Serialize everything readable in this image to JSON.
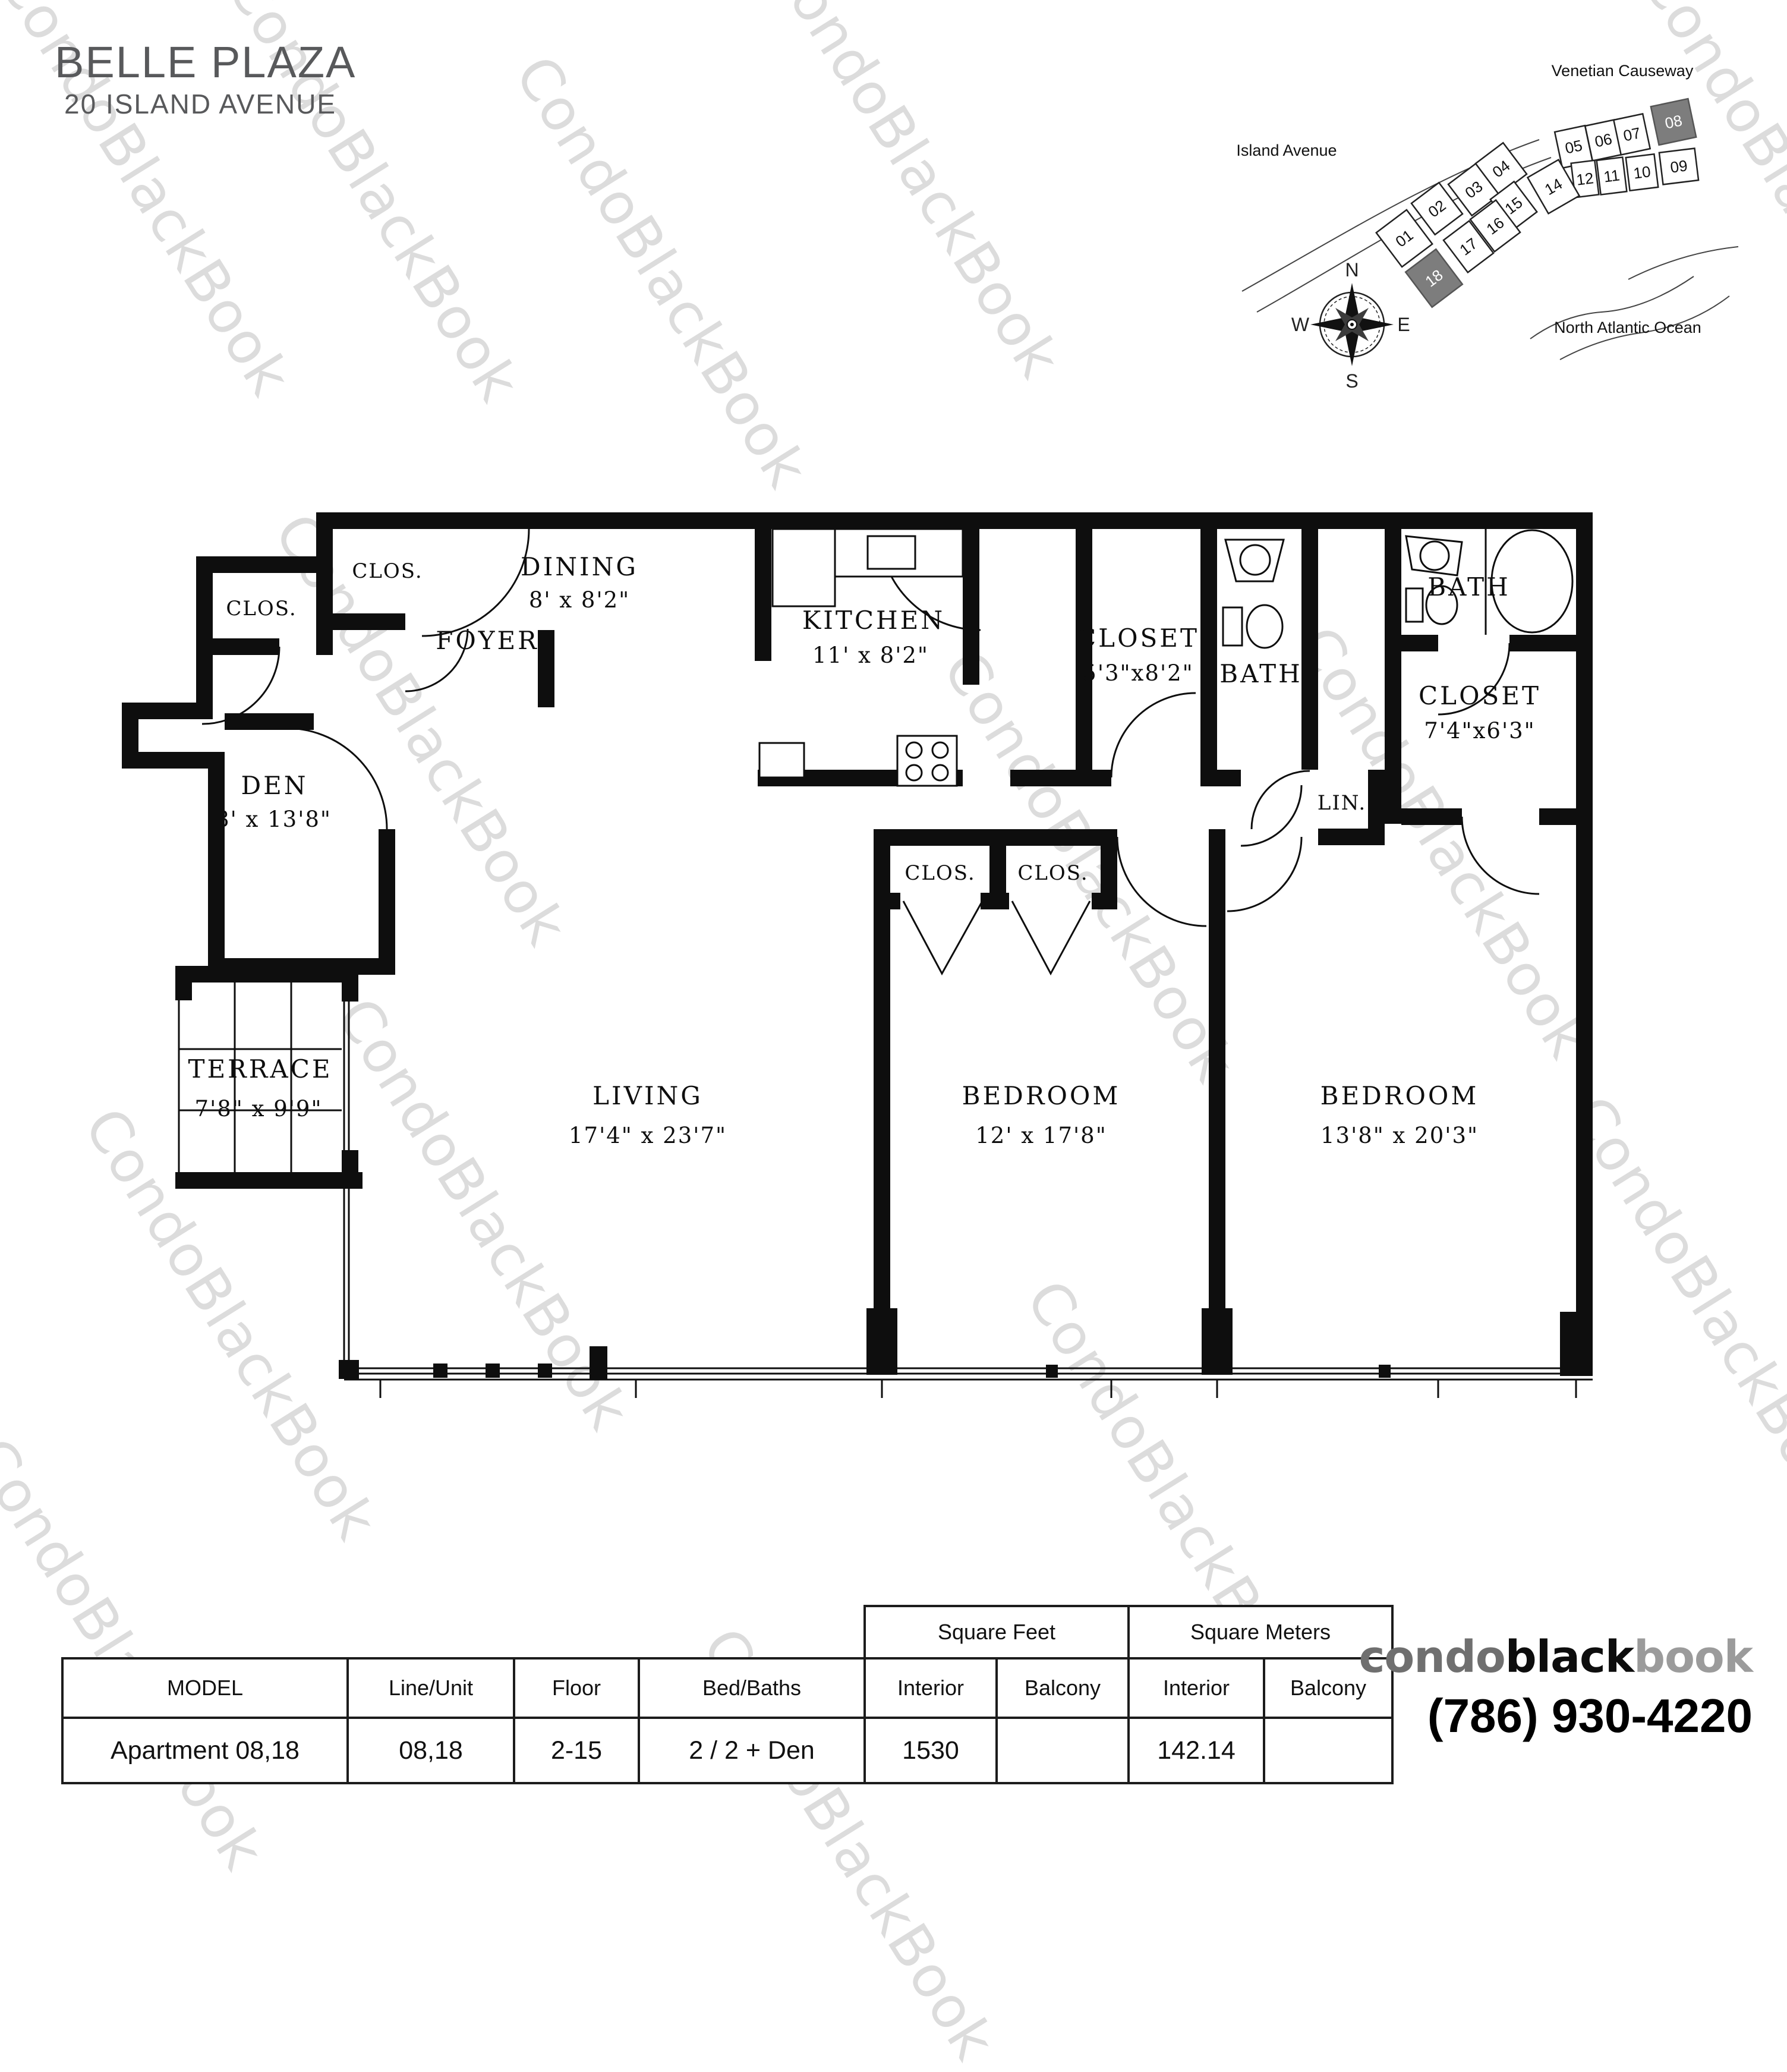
{
  "header": {
    "title": "BELLE PLAZA",
    "address": "20 ISLAND AVENUE"
  },
  "watermark": {
    "text": "CondoBlackBook"
  },
  "site_map": {
    "labels": {
      "causeway": "Venetian Causeway",
      "avenue": "Island Avenue",
      "ocean": "North Atlantic Ocean"
    },
    "compass": {
      "north": "N",
      "east": "E",
      "south": "S",
      "west": "W"
    },
    "highlight_color": "#7d7d7d",
    "units": [
      {
        "label": "01",
        "highlighted": false
      },
      {
        "label": "02",
        "highlighted": false
      },
      {
        "label": "03",
        "highlighted": false
      },
      {
        "label": "04",
        "highlighted": false
      },
      {
        "label": "05",
        "highlighted": false
      },
      {
        "label": "06",
        "highlighted": false
      },
      {
        "label": "07",
        "highlighted": false
      },
      {
        "label": "08",
        "highlighted": true
      },
      {
        "label": "09",
        "highlighted": false
      },
      {
        "label": "10",
        "highlighted": false
      },
      {
        "label": "11",
        "highlighted": false
      },
      {
        "label": "12",
        "highlighted": false
      },
      {
        "label": "14",
        "highlighted": false
      },
      {
        "label": "15",
        "highlighted": false
      },
      {
        "label": "16",
        "highlighted": false
      },
      {
        "label": "17",
        "highlighted": false
      },
      {
        "label": "18",
        "highlighted": true
      }
    ]
  },
  "floor_plan": {
    "rooms": {
      "closet_entry_1": {
        "name": "CLOS."
      },
      "closet_entry_2": {
        "name": "CLOS."
      },
      "foyer": {
        "name": "FOYER"
      },
      "dining": {
        "name": "DINING",
        "dims": "8' x 8'2\""
      },
      "kitchen": {
        "name": "KITCHEN",
        "dims": "11' x 8'2\""
      },
      "hall_closet": {
        "name": "CLOSET",
        "dims": "5'3\"x8'2\""
      },
      "bath_1": {
        "name": "BATH"
      },
      "bath_2": {
        "name": "BATH"
      },
      "master_closet": {
        "name": "CLOSET",
        "dims": "7'4\"x6'3\""
      },
      "linen": {
        "name": "LIN."
      },
      "den": {
        "name": "DEN",
        "dims": "8' x 13'8\""
      },
      "bedroom_closet_1": {
        "name": "CLOS."
      },
      "bedroom_closet_2": {
        "name": "CLOS."
      },
      "living": {
        "name": "LIVING",
        "dims": "17'4\" x 23'7\""
      },
      "bedroom_1": {
        "name": "BEDROOM",
        "dims": "12' x 17'8\""
      },
      "bedroom_2": {
        "name": "BEDROOM",
        "dims": "13'8\" x 20'3\""
      },
      "terrace": {
        "name": "TERRACE",
        "dims": "7'8\" x 9'9\""
      }
    }
  },
  "table": {
    "group_headers": {
      "square_feet": "Square Feet",
      "square_meters": "Square Meters"
    },
    "columns": {
      "model": "MODEL",
      "line_unit": "Line/Unit",
      "floor": "Floor",
      "bed_baths": "Bed/Baths",
      "sf_interior": "Interior",
      "sf_balcony": "Balcony",
      "sm_interior": "Interior",
      "sm_balcony": "Balcony"
    },
    "row": {
      "model": "Apartment 08,18",
      "line_unit": "08,18",
      "floor": "2-15",
      "bed_baths": "2 / 2 + Den",
      "sf_interior": "1530",
      "sf_balcony": "",
      "sm_interior": "142.14",
      "sm_balcony": ""
    }
  },
  "branding": {
    "logo": {
      "part1": "condo",
      "part2": "black",
      "part3": "book"
    },
    "phone": "(786) 930-4220"
  }
}
